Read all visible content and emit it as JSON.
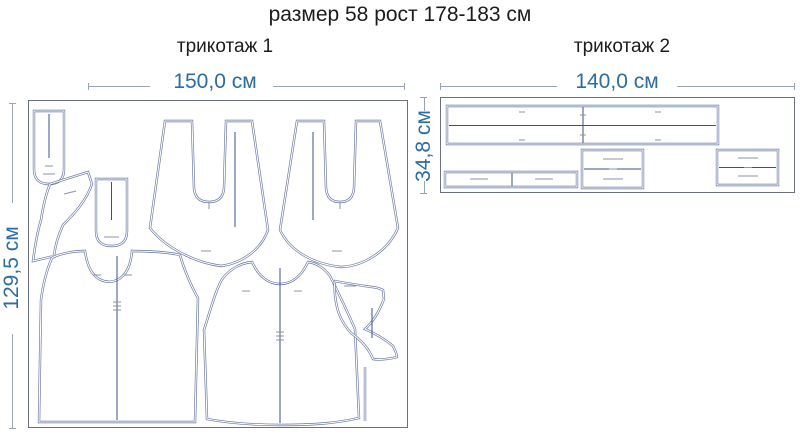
{
  "title": "размер 58 рост 178-183 см",
  "sections": {
    "knit1": {
      "label": "трикотаж 1",
      "width_label": "150,0 см",
      "height_label": "129,5 см"
    },
    "knit2": {
      "label": "трикотаж 2",
      "width_label": "140,0 см",
      "height_label": "34,8 см"
    }
  },
  "colors": {
    "title_text": "#1c1c1c",
    "dimension_text": "#2b6ca3",
    "dimension_line": "#9aa3b2",
    "outline": "#6674a0",
    "fold_line": "#3e4f87",
    "panel_border": "#6a7080",
    "tiny_mark": "#8b93a8"
  }
}
